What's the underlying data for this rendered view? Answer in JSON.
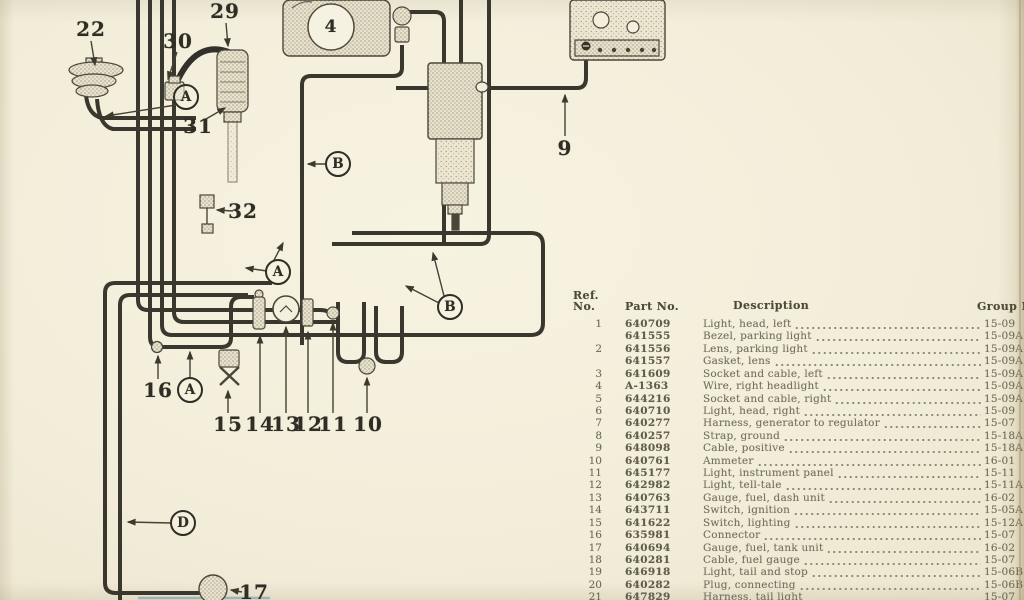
{
  "page": {
    "paper_color": "#f3eeda",
    "ink_color": "#3a372e"
  },
  "diagram": {
    "components": [
      "horn",
      "harness-connector",
      "suppressor-coil",
      "headlight",
      "headlight-connector",
      "ignition-coil",
      "voltage-regulator",
      "ground-connector",
      "connector-16",
      "lighting-switch",
      "ignition-switch",
      "fuel-dash-gauge",
      "telltale-light",
      "panel-light-connector",
      "ammeter-connector",
      "fuel-tank-unit"
    ],
    "number_callouts": [
      {
        "id": "callout-22",
        "label": "22",
        "x": 91,
        "y": 29
      },
      {
        "id": "callout-29",
        "label": "29",
        "x": 225,
        "y": 11
      },
      {
        "id": "callout-30",
        "label": "30",
        "x": 178,
        "y": 41
      },
      {
        "id": "callout-31",
        "label": "31",
        "x": 198,
        "y": 126
      },
      {
        "id": "callout-32",
        "label": "32",
        "x": 243,
        "y": 211
      },
      {
        "id": "callout-4",
        "label": "4",
        "x": 331,
        "y": 27,
        "small": true
      },
      {
        "id": "callout-9",
        "label": "9",
        "x": 565,
        "y": 148
      },
      {
        "id": "callout-16",
        "label": "16",
        "x": 158,
        "y": 390
      },
      {
        "id": "callout-15",
        "label": "15",
        "x": 228,
        "y": 424
      },
      {
        "id": "callout-14",
        "label": "14",
        "x": 260,
        "y": 424
      },
      {
        "id": "callout-13",
        "label": "13",
        "x": 286,
        "y": 424
      },
      {
        "id": "callout-12",
        "label": "12",
        "x": 308,
        "y": 424
      },
      {
        "id": "callout-11",
        "label": "11",
        "x": 333,
        "y": 424
      },
      {
        "id": "callout-10",
        "label": "10",
        "x": 368,
        "y": 424
      },
      {
        "id": "callout-17",
        "label": "17",
        "x": 254,
        "y": 592
      }
    ],
    "letter_callouts": [
      {
        "id": "letter-A-top",
        "label": "A",
        "x": 186,
        "y": 97
      },
      {
        "id": "letter-B-top",
        "label": "B",
        "x": 338,
        "y": 164
      },
      {
        "id": "letter-A-middle",
        "label": "A",
        "x": 278,
        "y": 272
      },
      {
        "id": "letter-B-middle",
        "label": "B",
        "x": 450,
        "y": 307
      },
      {
        "id": "letter-A-lower",
        "label": "A",
        "x": 190,
        "y": 390
      },
      {
        "id": "letter-D",
        "label": "D",
        "x": 183,
        "y": 523
      }
    ]
  },
  "parts_table": {
    "headers": {
      "ref_line1": "Ref.",
      "ref_line2": "No.",
      "part": "Part No.",
      "description": "Description",
      "group": "Group No."
    },
    "rows": [
      {
        "ref": "1",
        "part": "640709",
        "desc": "Light, head, left",
        "group": "15-09"
      },
      {
        "ref": "",
        "part": "641555",
        "desc": "Bezel, parking light",
        "group": "15-09A"
      },
      {
        "ref": "2",
        "part": "641556",
        "desc": "Lens, parking light",
        "group": "15-09A"
      },
      {
        "ref": "",
        "part": "641557",
        "desc": "Gasket, lens",
        "group": "15-09A"
      },
      {
        "ref": "3",
        "part": "641609",
        "desc": "Socket and cable, left",
        "group": "15-09A"
      },
      {
        "ref": "4",
        "part": "A-1363",
        "desc": "Wire, right headlight",
        "group": "15-09A"
      },
      {
        "ref": "5",
        "part": "644216",
        "desc": "Socket and cable, right",
        "group": "15-09A"
      },
      {
        "ref": "6",
        "part": "640710",
        "desc": "Light, head, right",
        "group": "15-09"
      },
      {
        "ref": "7",
        "part": "640277",
        "desc": "Harness, generator to regulator",
        "group": "15-07"
      },
      {
        "ref": "8",
        "part": "640257",
        "desc": "Strap, ground",
        "group": "15-18A"
      },
      {
        "ref": "9",
        "part": "648098",
        "desc": "Cable, positive",
        "group": "15-18A"
      },
      {
        "ref": "10",
        "part": "640761",
        "desc": "Ammeter",
        "group": "16-01"
      },
      {
        "ref": "11",
        "part": "645177",
        "desc": "Light, instrument panel",
        "group": "15-11"
      },
      {
        "ref": "12",
        "part": "642982",
        "desc": "Light, tell-tale",
        "group": "15-11A"
      },
      {
        "ref": "13",
        "part": "640763",
        "desc": "Gauge, fuel, dash unit",
        "group": "16-02"
      },
      {
        "ref": "14",
        "part": "643711",
        "desc": "Switch, ignition",
        "group": "15-05A"
      },
      {
        "ref": "15",
        "part": "641622",
        "desc": "Switch, lighting",
        "group": "15-12A"
      },
      {
        "ref": "16",
        "part": "635981",
        "desc": "Connector",
        "group": "15-07"
      },
      {
        "ref": "17",
        "part": "640694",
        "desc": "Gauge, fuel, tank unit",
        "group": "16-02"
      },
      {
        "ref": "18",
        "part": "640281",
        "desc": "Cable, fuel gauge",
        "group": "15-07"
      },
      {
        "ref": "19",
        "part": "646918",
        "desc": "Light, tail and stop",
        "group": "15-06B"
      },
      {
        "ref": "20",
        "part": "640282",
        "desc": "Plug, connecting",
        "group": "15-06B"
      },
      {
        "ref": "21",
        "part": "647829",
        "desc": "Harness, tail light",
        "group": "15-07"
      }
    ]
  }
}
